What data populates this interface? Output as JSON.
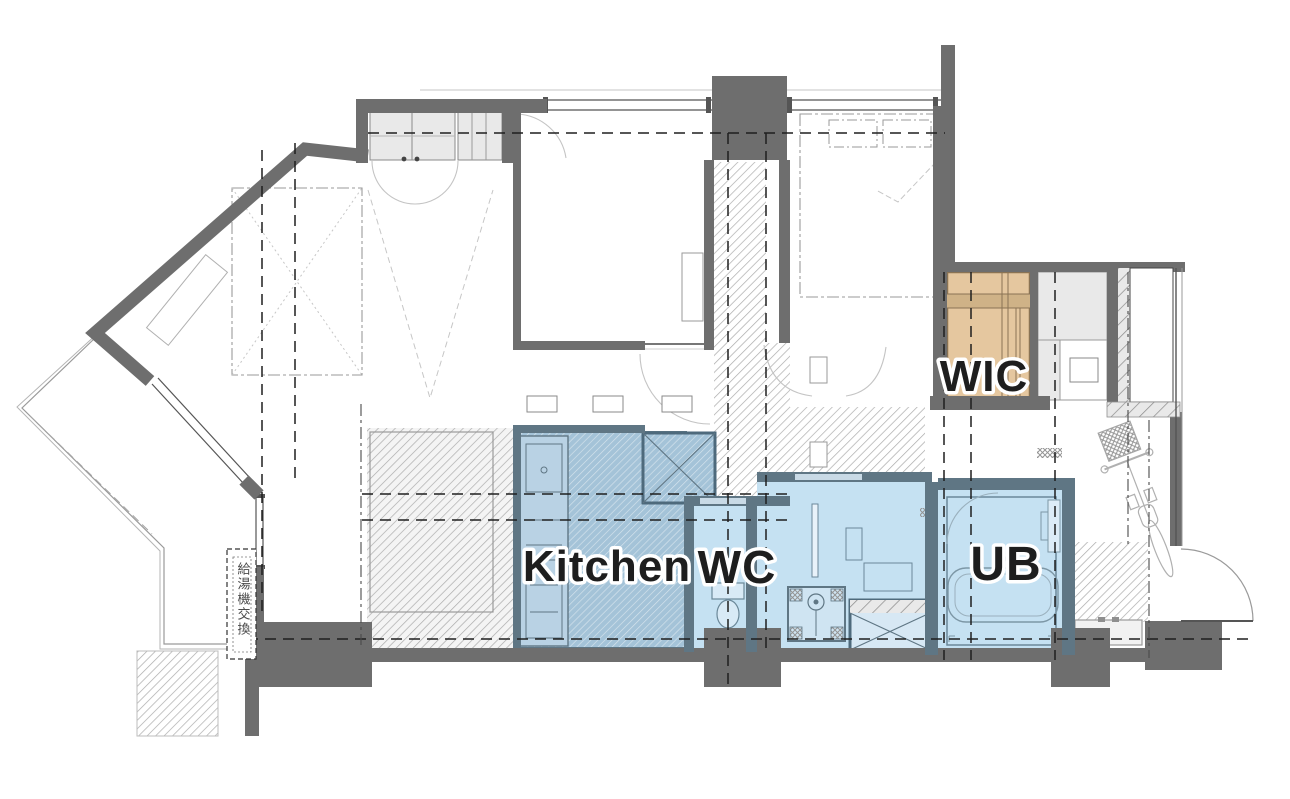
{
  "plan": {
    "type": "apartment-floor-plan",
    "rooms": {
      "kitchen": {
        "label": "Kitchen",
        "fill": "#a4c3d8"
      },
      "toilet": {
        "label": "WC",
        "fill": "#c5e1f2"
      },
      "bath_unit": {
        "label": "UB",
        "fill": "#c5e1f2"
      },
      "walk_in_closet": {
        "label": "WIC",
        "fill": "#e5c79f"
      }
    },
    "annotations": {
      "water_heater_note": "給湯機交換"
    },
    "colors": {
      "wall": "#6e6e6e",
      "wet_area_wall": "#5f7684",
      "wet_area_fill": "#c5e1f2",
      "kitchen_hatch_base": "#a4c3d8",
      "wic_fill": "#e5c79f",
      "wic_band": "#cfb287",
      "wic_line": "#8a7354",
      "closet_fill": "#e9e9e9",
      "floor_hatch_line": "#ababab",
      "dash_line": "#1f1f1f",
      "thin_line": "#9a9a9a",
      "label_text": "#1e1e1e",
      "label_halo": "#ffffff"
    }
  }
}
